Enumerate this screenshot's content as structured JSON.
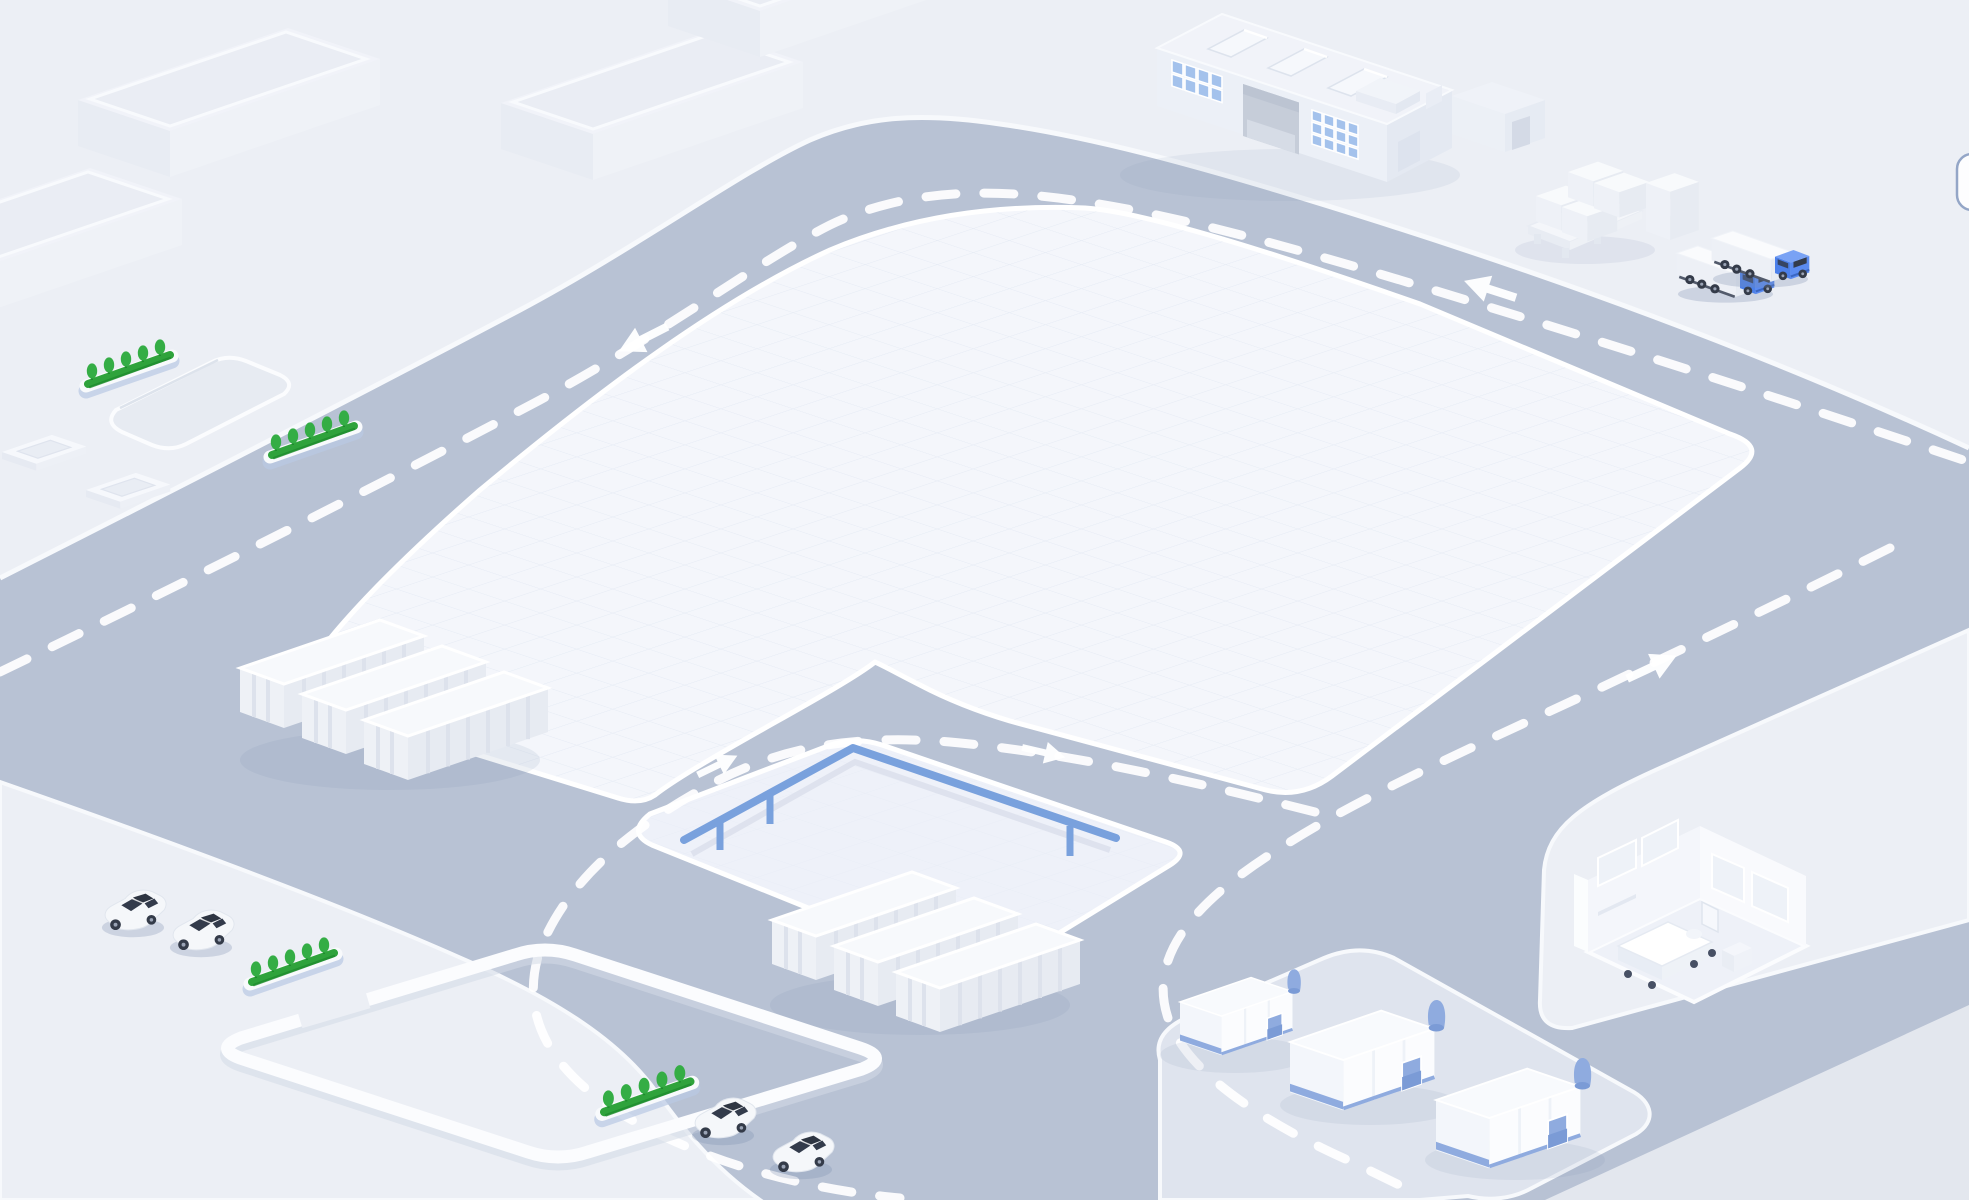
{
  "scene": {
    "title": "Isometric logistics campus",
    "description": "Isometric map with ring road, central pads, factory, slab warehouses, container stacks, box trucks, cars, hedge planters, warehouse tents and a hospital room cutaway",
    "projection": "isometric",
    "road": {
      "lane_marking": "white-dashed",
      "arrows": [
        {
          "id": "arrow-top-left",
          "direction": "left"
        },
        {
          "id": "arrow-top-right",
          "direction": "left"
        },
        {
          "id": "arrow-right-branch",
          "direction": "up-right"
        },
        {
          "id": "arrow-inner-left",
          "direction": "up-right"
        },
        {
          "id": "arrow-inner-right",
          "direction": "right"
        }
      ]
    },
    "objects": {
      "slab_buildings": 4,
      "factory_buildings": 1,
      "box_trucks": 2,
      "cars": 4,
      "hedge_planters": 4,
      "container_groups": 2,
      "containers_per_group": 3,
      "warehouse_tents": 3,
      "hospital_rooms": 1,
      "pallets": 1,
      "box_stacks": 2,
      "planter_frames": 2,
      "guardrails": 1,
      "recessed_pads": 1,
      "parking_curb_loops": 1
    }
  },
  "colors": {
    "bg": "#e7eaf1",
    "bg_deep": "#e3e7ee",
    "platform": "#eceff5",
    "platform_edge": "#f7f9fc",
    "road": "#b8c2d4",
    "pad": "#f4f6fb",
    "pad_grid": "#e3e9f3",
    "small_pad": "#eef1f9",
    "tent_platform": "#dfe4ee",
    "dash": "#ffffff",
    "railing": "#79a1dd",
    "railing_shadow": "#d9dfeb",
    "hedge": "#2fa33c",
    "hedge_dark": "#1f8c2e",
    "tree": "#34ad45",
    "planter": "#f8fafc",
    "planter_shadow": "#b9c9e4",
    "container_top": "#f7f9fc",
    "container_side": "#eef1f6",
    "container_face": "#e7ebf2",
    "rib": "#dde2ec",
    "truck_blue": "#4c80ea",
    "truck_blue_light": "#79a2f4",
    "truck_blue_side": "#5b8bf0",
    "trailer_top": "#fafbfd",
    "trailer_side": "#edf0f6",
    "trailer_end": "#e8ecf3",
    "wheel": "#343b49",
    "hub": "#9aa3b5",
    "glass": "#333b4b",
    "car_body": "#f5f7fa",
    "shadow": "rgba(122,140,172,0.28)",
    "tent_top": "#f8fafd",
    "tent_left": "#f3f6fb",
    "tent_right": "#fbfcfe",
    "tent_blue": "#8fabdf",
    "tent_blue_dark": "#7b9bd6",
    "factory_wall": "#ecf0f7",
    "factory_end": "#e4e9f2",
    "factory_roof": "#f1f3f9",
    "skylight": "#f6f8fc",
    "window": "#a4c2ec",
    "window_frame": "#ffffff",
    "door": "#c6cdd9",
    "door_dark": "#bcc4d2",
    "room_wall": "#f4f6fb",
    "room_wall_light": "#fbfdfe",
    "room_floor": "#eef1f8",
    "furniture": "#ffffff",
    "curb": "#fbfcfe",
    "curb_shadow": "#d3dae6",
    "pill_fill": "#fdfdfe",
    "pill_border": "#94a6c7"
  },
  "ui": {
    "right_edge_panel": {
      "shape": "rounded-rectangle",
      "clipped_at_right_edge": true
    }
  }
}
